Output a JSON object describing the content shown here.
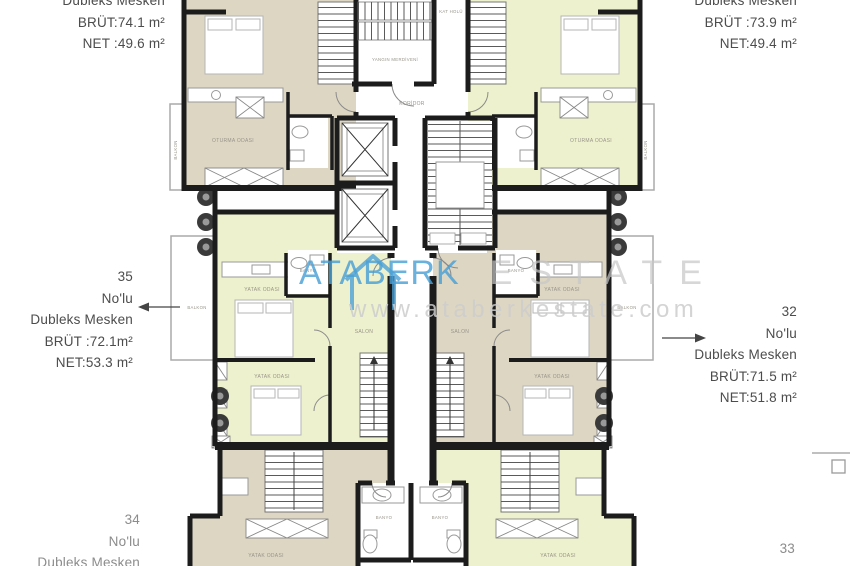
{
  "watermark": {
    "brand": "ATABERK",
    "brand_suffix": "ESTATE",
    "url": "www.ataberkestate.com"
  },
  "unit_labels": {
    "top_left": {
      "type": "Dubleks Mesken",
      "brut": "BRÜT:74.1 m²",
      "net": "NET :49.6 m²"
    },
    "top_right": {
      "type": "Dubleks Mesken",
      "brut": "BRÜT :73.9 m²",
      "net": "NET:49.4 m²"
    },
    "mid_left": {
      "no": "35",
      "nolu": "No'lu",
      "type": "Dubleks Mesken",
      "brut": "BRÜT :72.1m²",
      "net": "NET:53.3 m²"
    },
    "mid_right": {
      "no": "32",
      "nolu": "No'lu",
      "type": "Dubleks Mesken",
      "brut": "BRÜT:71.5 m²",
      "net": "NET:51.8 m²"
    },
    "bottom_left": {
      "no": "34",
      "nolu": "No'lu",
      "type": "Dubleks Mesken"
    },
    "bottom_right": {
      "no": "33"
    }
  },
  "rooms": {
    "living": "OTURMA ODASI",
    "bedroom": "YATAK ODASI",
    "salon": "SALON",
    "balcony": "BALKON",
    "bath": "BANYO",
    "corridor": "KORİDOR",
    "fire_stairs": "YANGIN MERDİVENİ",
    "stair_hall": "KAT HOLÜ"
  },
  "colors": {
    "wall": "#1c1c1c",
    "beige": "#ddd6c3",
    "pale_yellow": "#eef1cd",
    "watermark_blue": "#4aa0d6",
    "line_gray": "#9a9a9a"
  }
}
